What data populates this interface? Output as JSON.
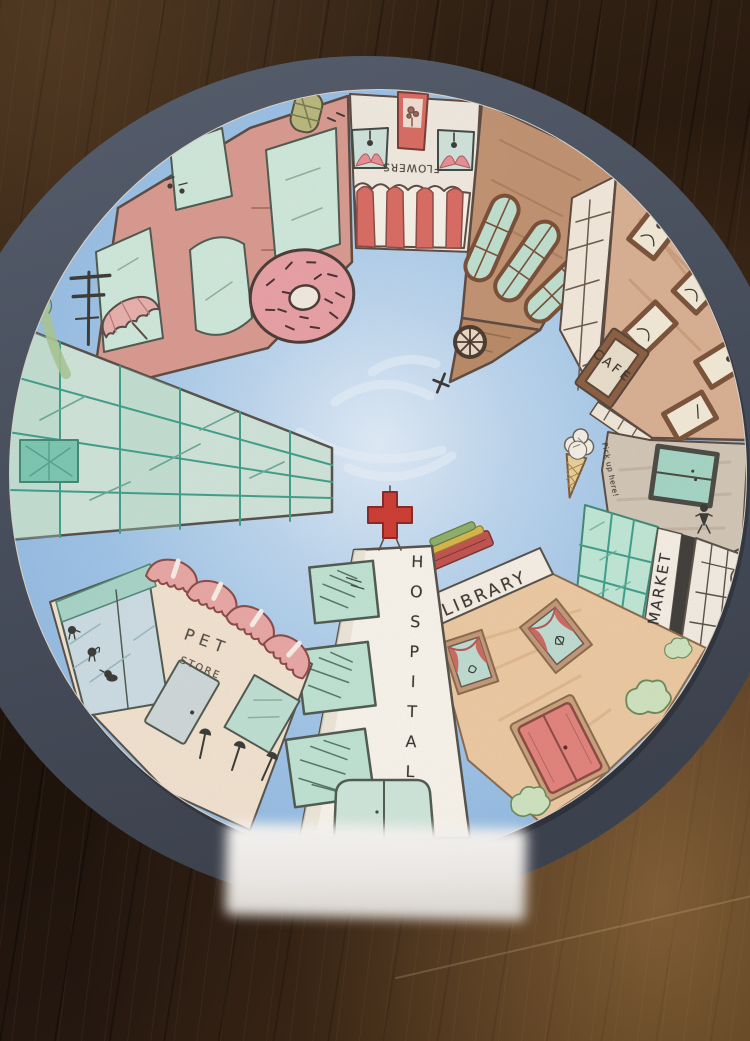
{
  "labels": {
    "flower_shop": "FLOWERS",
    "cafe": "CAFE",
    "pickup_note": "Pick up here!",
    "market": "MARKET",
    "library": "LIBRARY",
    "hospital": "HOSPITAL",
    "pet_store_line1": "PET",
    "pet_store_line2": "STORE"
  },
  "colors": {
    "construction_paper": "#49505e",
    "drawing_paper": "#f1eae0",
    "sky_blue": "#9ec4e8",
    "brick_pink": "#d99a90",
    "window_mint": "#cfe9dc",
    "awning_red": "#d96b63",
    "church_brown": "#c09272",
    "cafe_tan": "#d9b093",
    "frame_brown": "#7a5239",
    "grayshop_tan": "#d2c6b6",
    "market_green": "#bfe7d6",
    "library_tan": "#ecc9a2",
    "hospital_white": "#f8f4ec",
    "cross_red": "#cc3b33",
    "pet_cream": "#f2e2d0",
    "glass_teal": "#cfe4da",
    "donut_pink": "#e8a0a6",
    "door_red": "#e2837c"
  }
}
